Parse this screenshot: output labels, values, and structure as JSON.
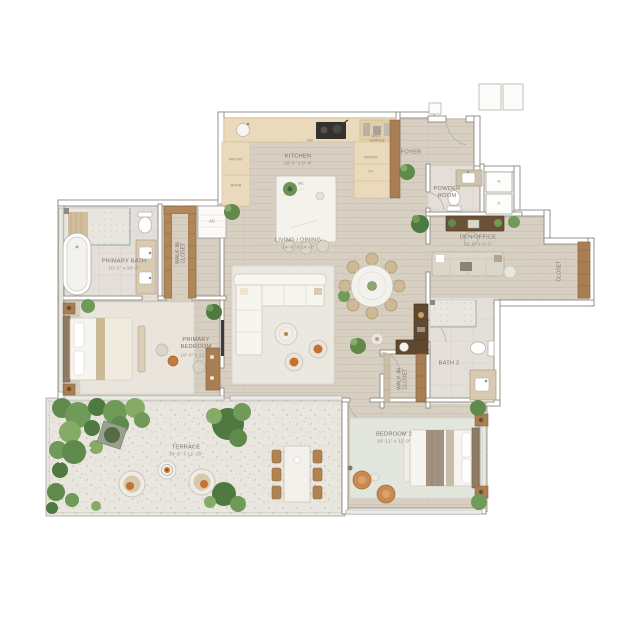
{
  "palette": {
    "wood_floor": "#d7cfc1",
    "tile_floor": "#e4e0d9",
    "terrace_floor": "#e8e6df",
    "wall_line": "#8f8a81",
    "cabinet_wood": "#a87e52",
    "dark_wood": "#5f482f",
    "counter": "#ead9ba",
    "plant_green": "#6f9a57",
    "accent_orange": "#c5712f",
    "label_text": "#7e7568"
  },
  "rooms": {
    "kitchen": {
      "name": "KITCHEN",
      "dims": "19'-6\" x 8'-4\""
    },
    "living_dining": {
      "name": "LIVING / DINING",
      "dims": "24'-8\" x 24'-0\""
    },
    "foyer": {
      "name": "FOYER"
    },
    "powder_room": {
      "name": "POWDER ROOM"
    },
    "den_office": {
      "name": "DEN/OFFICE",
      "dims": "13'-6\" x 9'-1\""
    },
    "den_closet": {
      "name": "CLOSET"
    },
    "primary_bath": {
      "name": "PRIMARY BATH",
      "dims": "10'-1\" x 10'-8\""
    },
    "primary_closet": {
      "name": "WALK-IN CLOSET",
      "dims": "8'-4\" x 8'-0\""
    },
    "primary_bedroom": {
      "name": "PRIMARY BEDROOM",
      "dims": "19'-3\" x 12'-4\""
    },
    "bath2": {
      "name": "BATH 2"
    },
    "closet2": {
      "name": "WALK-IN CLOSET"
    },
    "bedroom2": {
      "name": "BEDROOM 2",
      "dims": "16'-11\" x 12'-9\""
    },
    "terrace": {
      "name": "TERRACE",
      "dims": "34'-5\" x 12'-10\""
    }
  },
  "fixtures": {
    "dishwasher": "DW",
    "wine_cooler": "WC",
    "oven": "OV",
    "pantry_left": "PANTRY",
    "pantry_right": "PANTRY",
    "fridge": "RF/FR",
    "appliance_garage": "APPL GARAGE",
    "washer": "W",
    "dryer": "D",
    "ac_unit": "AC"
  }
}
